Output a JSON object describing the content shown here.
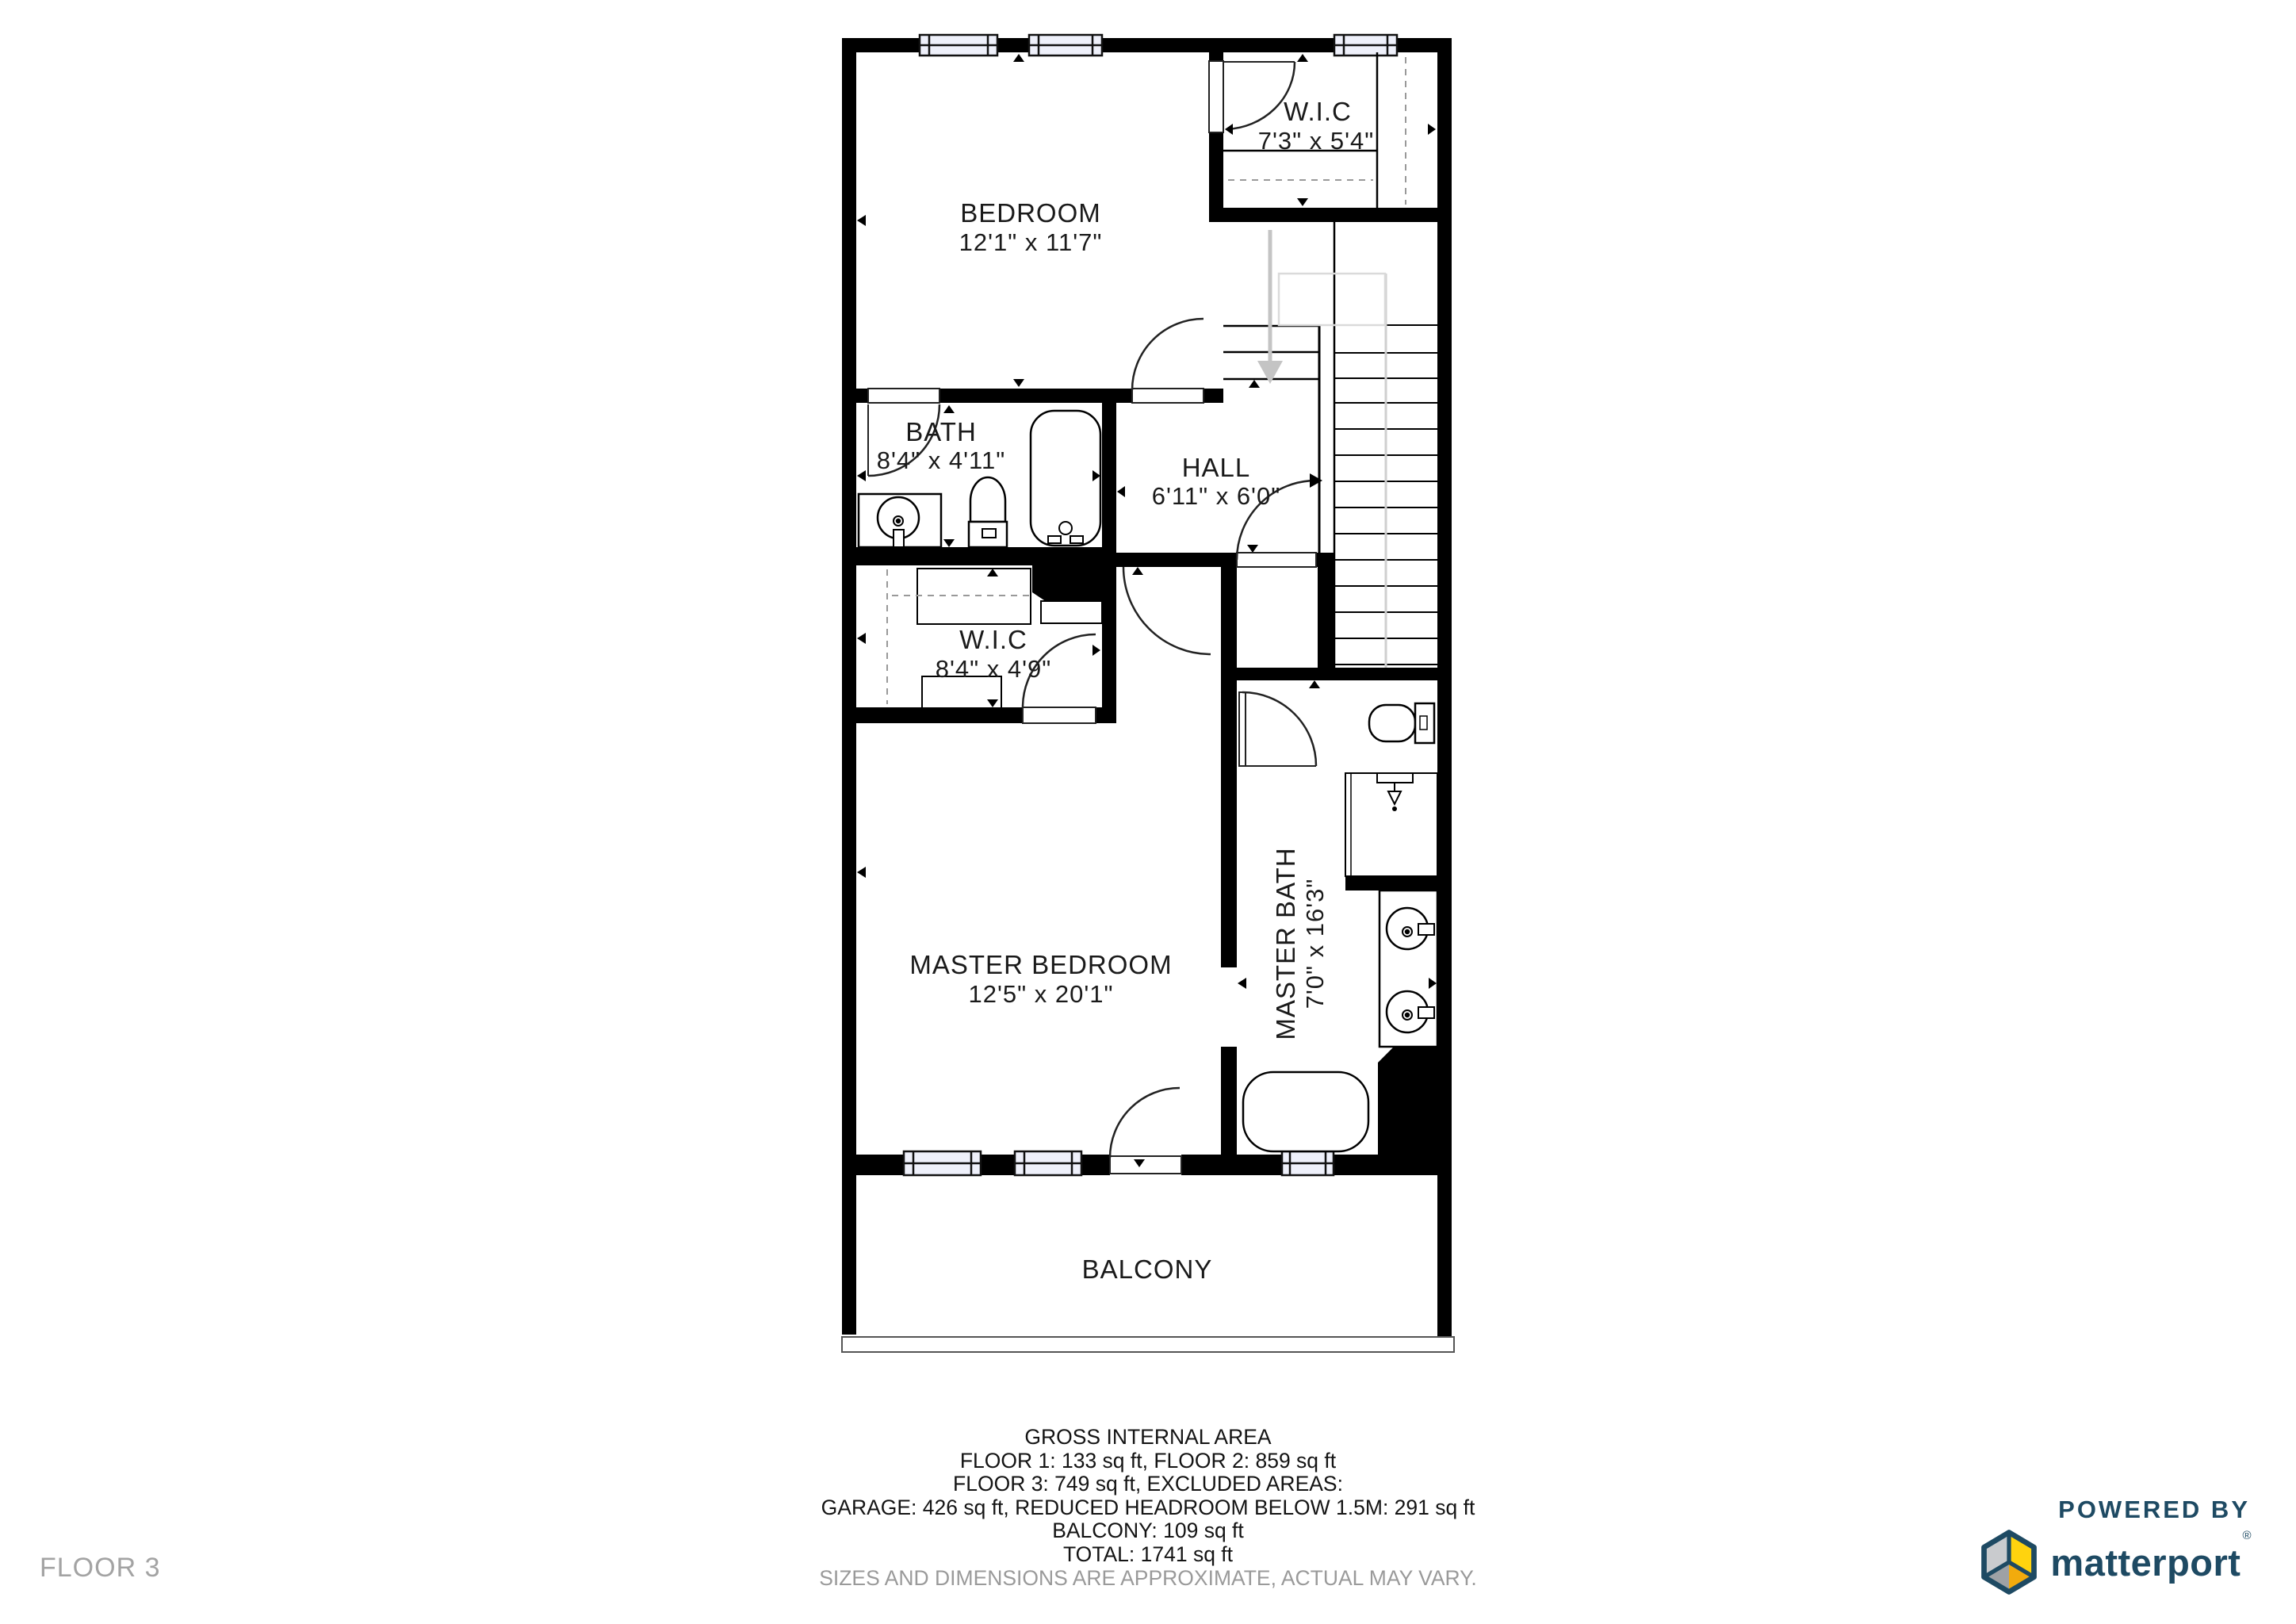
{
  "floor_label": "FLOOR 3",
  "rooms": {
    "bedroom": {
      "name": "BEDROOM",
      "dims": "12'1\" x 11'7\""
    },
    "wic_upper": {
      "name": "W.I.C",
      "dims": "7'3\" x 5'4\""
    },
    "bath": {
      "name": "BATH",
      "dims": "8'4\" x 4'11\""
    },
    "hall": {
      "name": "HALL",
      "dims": "6'11\" x 6'0\""
    },
    "wic_master": {
      "name": "W.I.C",
      "dims": "8'4\" x 4'9\""
    },
    "master_bedroom": {
      "name": "MASTER BEDROOM",
      "dims": "12'5\" x 20'1\""
    },
    "master_bath": {
      "name": "MASTER BATH",
      "dims": "7'0\" x 16'3\""
    },
    "balcony": {
      "name": "BALCONY"
    }
  },
  "footer": {
    "title": "GROSS INTERNAL AREA",
    "lines": [
      "FLOOR 1: 133 sq ft, FLOOR 2: 859 sq ft",
      "FLOOR 3: 749 sq ft, EXCLUDED AREAS:",
      "GARAGE: 426 sq ft, REDUCED HEADROOM BELOW 1.5M: 291 sq ft",
      "BALCONY: 109 sq ft",
      "TOTAL: 1741 sq ft"
    ],
    "disclaimer": "SIZES AND DIMENSIONS ARE APPROXIMATE, ACTUAL MAY VARY."
  },
  "branding": {
    "powered_by": "POWERED BY",
    "name": "matterport",
    "registered": "®"
  },
  "colors": {
    "navy": "#1e4a63",
    "logo_yellow": "#ffd30e",
    "logo_gold": "#f2ab0d",
    "logo_gray_light": "#c9cbce",
    "logo_gray": "#9ea1a5",
    "wall_black": "#000000",
    "window_fill": "#eef0fa",
    "stair_gray": "#c4c4c4"
  }
}
